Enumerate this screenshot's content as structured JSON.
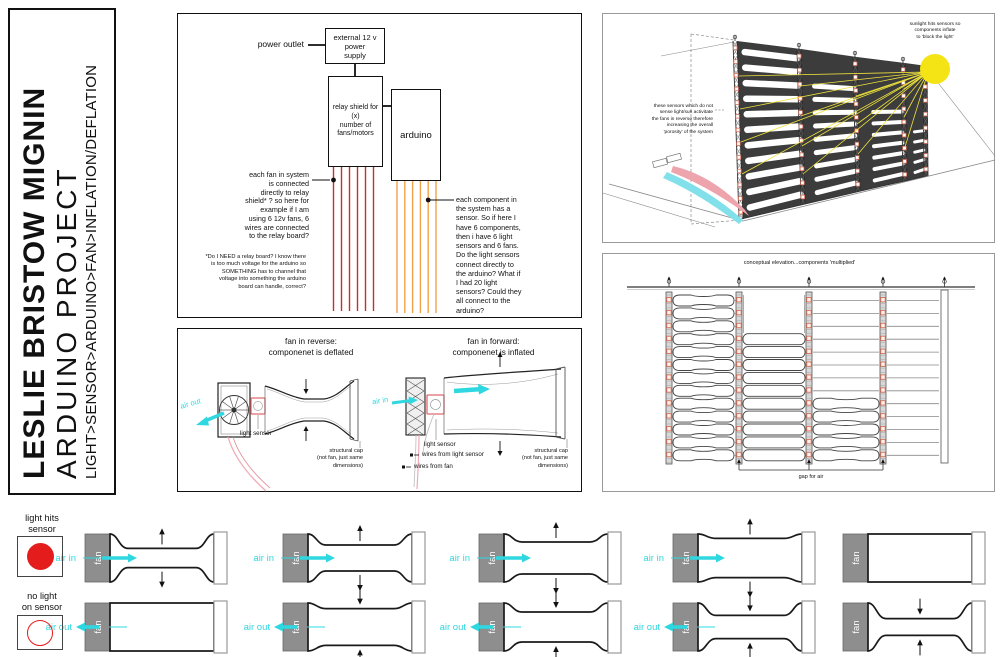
{
  "title": {
    "name": "LESLIE BRISTOW MIGNIN",
    "project": "ARDUINO PROJECT",
    "subtitle": "LIGHT>SENSOR>ARDUINO>FAN>INFLATION/DEFLATION"
  },
  "wiring": {
    "power_outlet": "power outlet",
    "supply_box": "external 12 v\npower\nsupply",
    "relay_box": "relay shield for (x)\nnumber of\nfans/motors",
    "arduino_box": "arduino",
    "left_note": "each fan in system\nis connected\ndirectly to relay\nshield* ? so here for\nexample if I am\nusing 6 12v fans, 6\nwires are connected\nto the relay board?",
    "footnote": "*Do I NEED a relay board? I know there\nis too much voltage for the arduino so\nSOMETHING has to channel that\nvoltage into something the arduino\nboard can handle, correct?",
    "right_note": "each component in\nthe system has a\nsensor. So if here I\nhave 6 components,\nthen i have 6 light\nsensors and 6 fans.\nDo the light sensors\nconnect directly to\nthe arduino? What if\nI had 20 light\nsensors? Could they\nall connect to the\narduino?",
    "fan_wire_count": 6,
    "sensor_wire_count": 6
  },
  "fan_states": {
    "reverse": {
      "title": "fan in reverse:\ncomponenet is deflated",
      "air_label": "air out",
      "sensor_label": "light sensor",
      "cap_label": "structural cap\n(not fan, just same\ndimensions)"
    },
    "forward": {
      "title": "fan in forward:\ncomponenet is inflated",
      "air_label": "air in",
      "sensor_label": "light sensor",
      "wires_sensor_label": "wires from light sensor",
      "wires_fan_label": "wires from fan",
      "cap_label": "structural cap\n(not fan, just same\ndimensions)"
    }
  },
  "perspective": {
    "sun_note": "sunlight hits sensors so\ncomponents inflate\nto 'block the light'",
    "left_note": "these sensors which do not\nsense light/sun activitate\nthe fans in reverse therefore\nincreasing the overall\n'porosity' of the system"
  },
  "elevation": {
    "title": "conceptual elevation...components 'multiplied'",
    "gap_label": "gap for air",
    "bay_count": 4,
    "rows": 13
  },
  "bottom": {
    "fan_label": "fan",
    "legend": [
      {
        "label": "light hits\nsensor",
        "circle": "filled"
      },
      {
        "label": "no light\non sensor",
        "circle": "outline"
      }
    ],
    "rows": [
      {
        "stages": [
          {
            "pinch": 0.72,
            "air": "air in",
            "arrows": "out"
          },
          {
            "pinch": 0.55,
            "air": "air in",
            "arrows": "out"
          },
          {
            "pinch": 0.4,
            "air": "air in",
            "arrows": "out"
          },
          {
            "pinch": 0.22,
            "air": "air in",
            "arrows": "out"
          },
          {
            "pinch": 0.0,
            "air": "",
            "arrows": ""
          }
        ]
      },
      {
        "stages": [
          {
            "pinch": 0.0,
            "air": "air out",
            "arrows": ""
          },
          {
            "pinch": 0.28,
            "air": "air out",
            "arrows": "in"
          },
          {
            "pinch": 0.45,
            "air": "air out",
            "arrows": "in"
          },
          {
            "pinch": 0.62,
            "air": "air out",
            "arrows": "in"
          },
          {
            "pinch": 0.78,
            "air": "",
            "arrows": "in"
          }
        ]
      }
    ]
  },
  "colors": {
    "wire_red": "#c5302c",
    "wire_orange": "#f2a24a",
    "air_cyan": "#2fd8e0",
    "sensor_red": "#e51c1c",
    "fan_gray": "#8e8e8e",
    "sun_yellow": "#f5e415",
    "ray_yellow": "#eee23c",
    "elev_sensor": "#d9705a",
    "pink": "#eda4ad",
    "streamer_cyan": "#82e0ea",
    "dark_wall": "#3c3c3c",
    "wire_pink": "#f2aab4"
  }
}
